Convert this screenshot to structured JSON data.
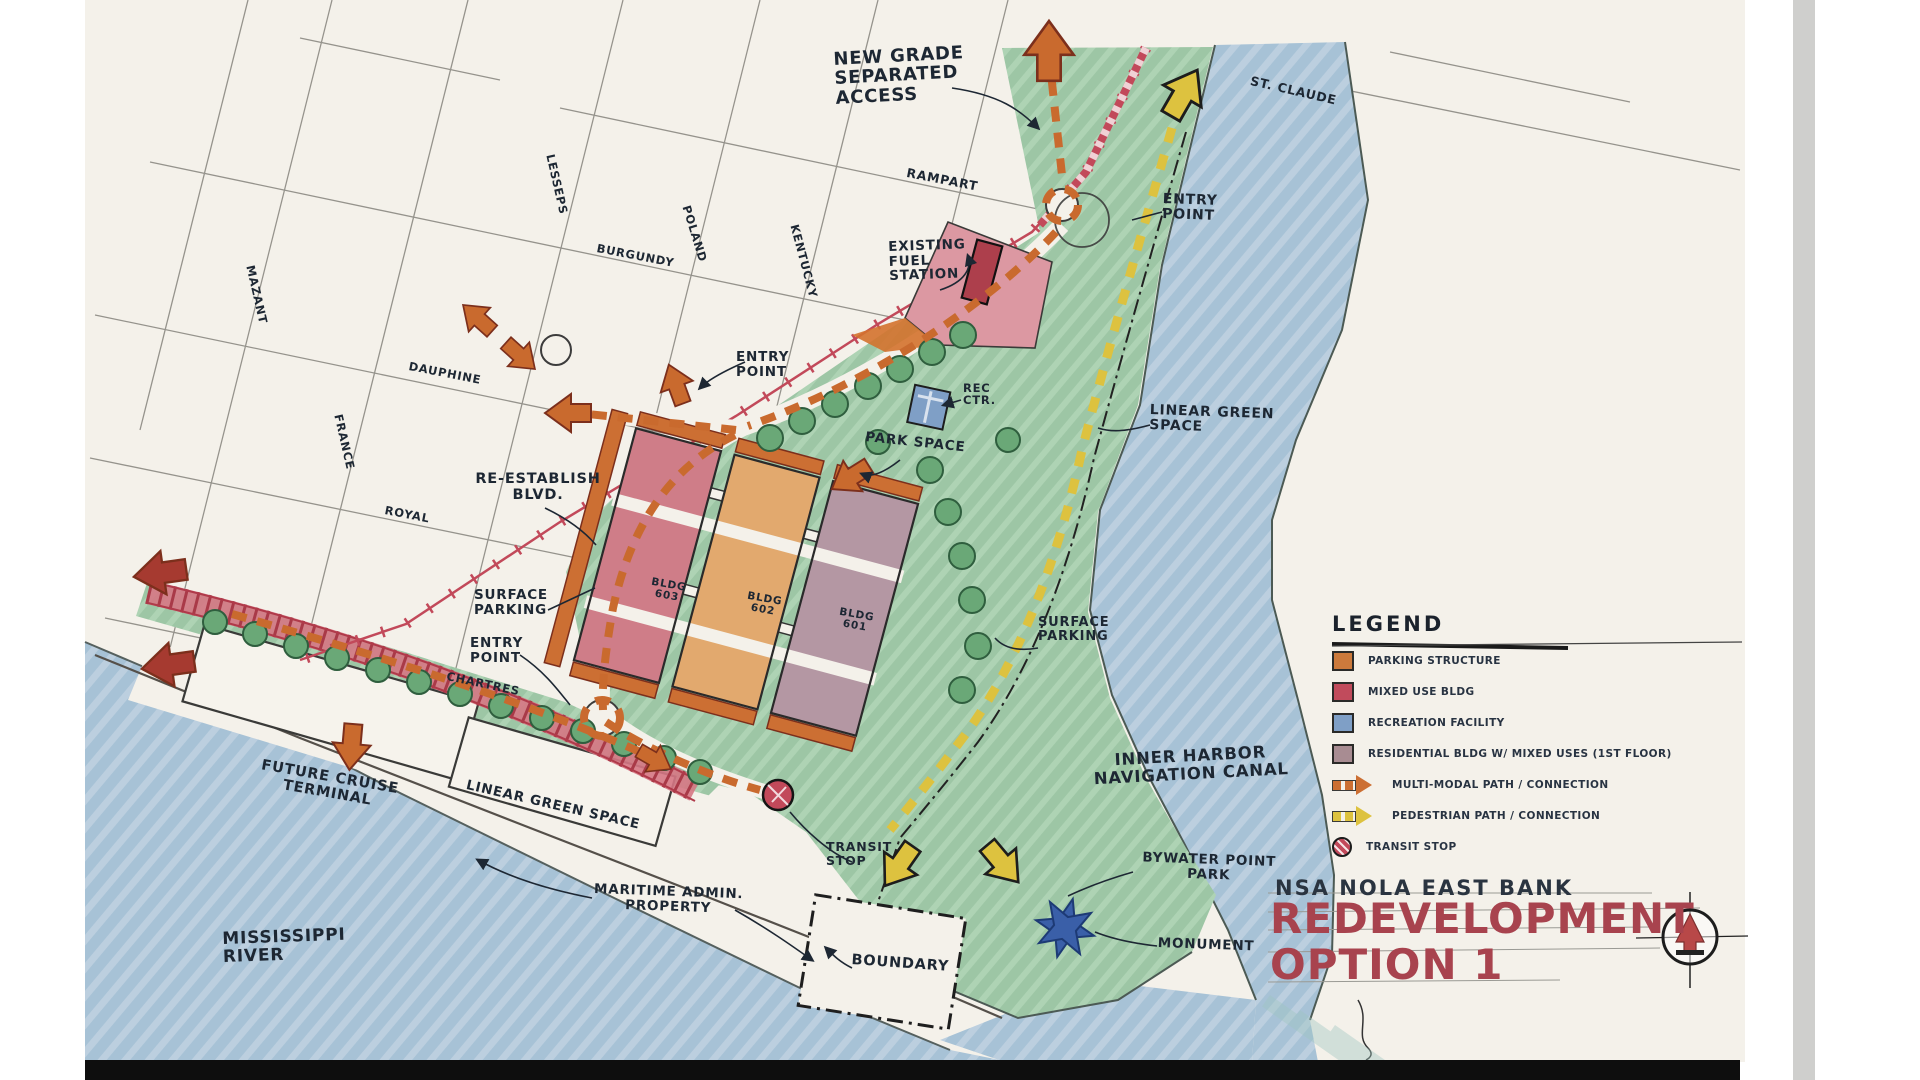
{
  "title_block": {
    "project": "NSA NOLA EAST BANK",
    "title_line1": "REDEVELOPMENT",
    "title_line2": "OPTION 1",
    "accent_color": "#a8434e"
  },
  "legend": {
    "title": "LEGEND",
    "items": [
      {
        "type": "square",
        "color": "#cc7a3c",
        "label": "PARKING STRUCTURE"
      },
      {
        "type": "square",
        "color": "#c14b5c",
        "label": "MIXED USE BLDG"
      },
      {
        "type": "square",
        "color": "#7f9fc6",
        "label": "RECREATION FACILITY"
      },
      {
        "type": "square",
        "color": "#a88c92",
        "label": "RESIDENTIAL BLDG W/ MIXED USES (1ST FLOOR)"
      },
      {
        "type": "arrow",
        "color": "#cc6f33",
        "label": "MULTI-MODAL PATH / CONNECTION"
      },
      {
        "type": "arrow",
        "color": "#ddc23f",
        "label": "PEDESTRIAN PATH / CONNECTION"
      },
      {
        "type": "circle",
        "color": "#c2495a",
        "label": "TRANSIT STOP"
      }
    ]
  },
  "annotations": [
    {
      "id": "new-grade-access",
      "text": "NEW GRADE\nSEPARATED\nACCESS",
      "x": 833,
      "y": 50,
      "size": 18,
      "rot": -3
    },
    {
      "id": "street-rampart",
      "text": "RAMPART",
      "x": 908,
      "y": 166,
      "size": 12.5,
      "rot": 11
    },
    {
      "id": "street-st-claude",
      "text": "ST. CLAUDE",
      "x": 1252,
      "y": 74,
      "size": 12.5,
      "rot": 13
    },
    {
      "id": "entry-point-ne",
      "text": "ENTRY\nPOINT",
      "x": 1163,
      "y": 192,
      "size": 14,
      "rot": 2
    },
    {
      "id": "existing-fuel-station",
      "text": "EXISTING\nFUEL\nSTATION",
      "x": 888,
      "y": 240,
      "size": 13.5,
      "rot": -2
    },
    {
      "id": "entry-point-west",
      "text": "ENTRY\nPOINT",
      "x": 736,
      "y": 350,
      "size": 13.5,
      "rot": 0
    },
    {
      "id": "street-kentucky",
      "text": "KENTUCKY",
      "x": 800,
      "y": 223,
      "size": 11.5,
      "rot": 75
    },
    {
      "id": "street-lesseps",
      "text": "LESSEPS",
      "x": 556,
      "y": 153,
      "size": 11.5,
      "rot": 77
    },
    {
      "id": "street-burgundy",
      "text": "BURGUNDY",
      "x": 598,
      "y": 242,
      "size": 11.5,
      "rot": 11
    },
    {
      "id": "street-poland",
      "text": "POLAND",
      "x": 692,
      "y": 204,
      "size": 11.5,
      "rot": 73
    },
    {
      "id": "street-mazant",
      "text": "MAZANT",
      "x": 256,
      "y": 264,
      "size": 11.5,
      "rot": 77
    },
    {
      "id": "street-dauphine",
      "text": "DAUPHINE",
      "x": 410,
      "y": 360,
      "size": 11.5,
      "rot": 11
    },
    {
      "id": "street-france",
      "text": "FRANCE",
      "x": 344,
      "y": 413,
      "size": 11.5,
      "rot": 77
    },
    {
      "id": "rec-ctr",
      "text": "REC\nCTR.",
      "x": 963,
      "y": 382,
      "size": 11.5,
      "rot": 0
    },
    {
      "id": "park-space",
      "text": "PARK SPACE",
      "x": 866,
      "y": 430,
      "size": 13.5,
      "rot": 6
    },
    {
      "id": "linear-green-space-ne",
      "text": "LINEAR GREEN\nSPACE",
      "x": 1150,
      "y": 403,
      "size": 14,
      "rot": 2
    },
    {
      "id": "re-establish-blvd",
      "text": "RE-ESTABLISH\nBLVD.",
      "x": 468,
      "y": 472,
      "size": 14.5,
      "rot": 0,
      "w": 140,
      "align": "center"
    },
    {
      "id": "street-royal",
      "text": "ROYAL",
      "x": 386,
      "y": 504,
      "size": 11.5,
      "rot": 11
    },
    {
      "id": "surface-parking-west",
      "text": "SURFACE\nPARKING",
      "x": 474,
      "y": 588,
      "size": 13.5,
      "rot": 0
    },
    {
      "id": "entry-point-south",
      "text": "ENTRY\nPOINT",
      "x": 470,
      "y": 636,
      "size": 13.5,
      "rot": 0
    },
    {
      "id": "street-chartres",
      "text": "CHARTRES",
      "x": 448,
      "y": 670,
      "size": 11.5,
      "rot": 12
    },
    {
      "id": "surface-parking-east",
      "text": "SURFACE\nPARKING",
      "x": 1038,
      "y": 616,
      "size": 13,
      "rot": 0
    },
    {
      "id": "bldg-603",
      "text": "BLDG\n603",
      "x": 648,
      "y": 576,
      "size": 10.5,
      "rot": 10,
      "align": "center",
      "w": 44
    },
    {
      "id": "bldg-602",
      "text": "BLDG\n602",
      "x": 744,
      "y": 590,
      "size": 10.5,
      "rot": 10,
      "align": "center",
      "w": 44
    },
    {
      "id": "bldg-601",
      "text": "BLDG\n601",
      "x": 836,
      "y": 606,
      "size": 10.5,
      "rot": 10,
      "align": "center",
      "w": 44
    },
    {
      "id": "inner-harbor-canal",
      "text": "INNER HARBOR\nNAVIGATION CANAL",
      "x": 1080,
      "y": 753,
      "size": 16.5,
      "rot": -3,
      "w": 220,
      "align": "center"
    },
    {
      "id": "future-cruise-terminal",
      "text": "FUTURE CRUISE\nTERMINAL",
      "x": 250,
      "y": 756,
      "size": 14.5,
      "rot": 10,
      "w": 165,
      "align": "center"
    },
    {
      "id": "linear-green-space-s",
      "text": "LINEAR GREEN SPACE",
      "x": 468,
      "y": 778,
      "size": 13.5,
      "rot": 13
    },
    {
      "id": "maritime-admin",
      "text": "MARITIME ADMIN.\nPROPERTY",
      "x": 594,
      "y": 882,
      "size": 13.5,
      "rot": 2,
      "w": 150,
      "align": "center"
    },
    {
      "id": "transit-stop",
      "text": "TRANSIT\nSTOP",
      "x": 826,
      "y": 840,
      "size": 12.5,
      "rot": 0
    },
    {
      "id": "boundary",
      "text": "BOUNDARY",
      "x": 852,
      "y": 953,
      "size": 14.5,
      "rot": 4
    },
    {
      "id": "mississippi-river",
      "text": "MISSISSIPPI\nRIVER",
      "x": 222,
      "y": 930,
      "size": 17,
      "rot": -2
    },
    {
      "id": "bywater-point-park",
      "text": "BYWATER POINT\nPARK",
      "x": 1132,
      "y": 850,
      "size": 13.5,
      "rot": 2,
      "w": 155,
      "align": "center"
    },
    {
      "id": "monument",
      "text": "MONUMENT",
      "x": 1158,
      "y": 936,
      "size": 13.5,
      "rot": 2
    }
  ]
}
